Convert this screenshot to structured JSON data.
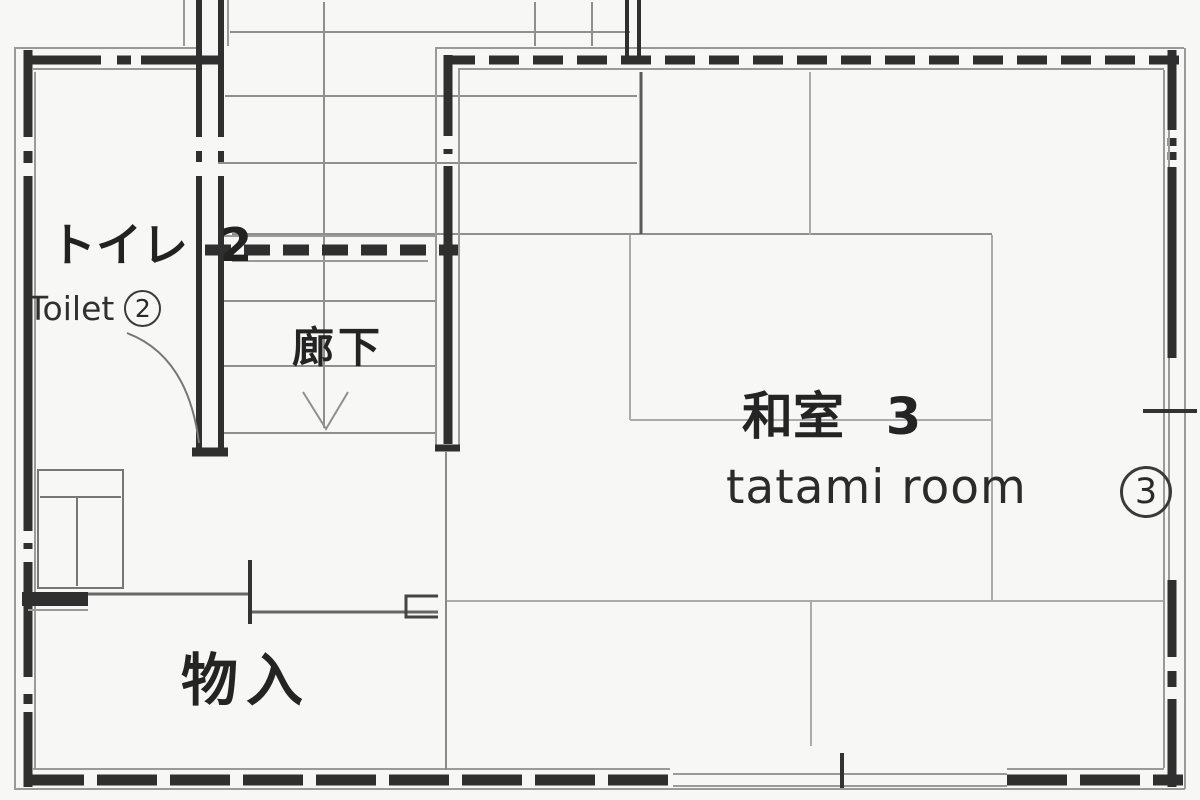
{
  "title": "second floor plan",
  "rooms": {
    "toilet": {
      "label_jp": "トイレ 2",
      "label_en": "Toilet",
      "number_circled": "2"
    },
    "corridor": {
      "label_jp": "廊下"
    },
    "tatami": {
      "label_jp": "和室 3",
      "label_en": "tatami room",
      "number_circled": "3"
    },
    "storage": {
      "label_jp": "物入"
    }
  },
  "colors": {
    "wall_dark": "#2f2f2f",
    "edge_gray": "#9a9a9a",
    "tread_gray": "#8f8f8f",
    "tatami_gray": "#ababab",
    "background": "#f7f7f5"
  }
}
